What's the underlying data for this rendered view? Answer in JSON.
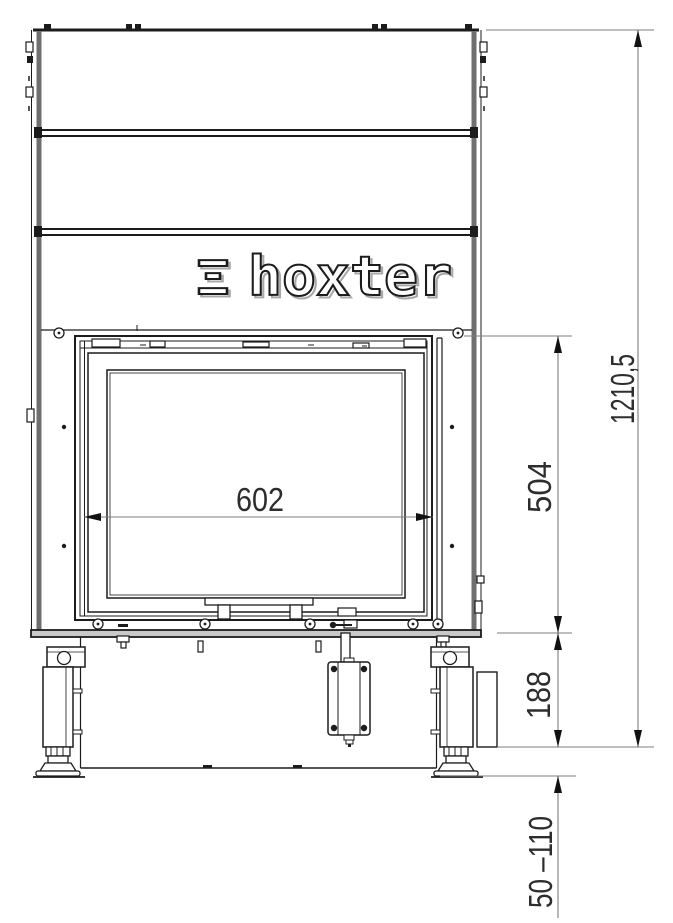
{
  "drawing": {
    "type": "fireplace-insert-front-view-technical-drawing",
    "brand": {
      "glyph": "Ξ",
      "name": "hoxter"
    },
    "dimension_labels": {
      "glass_width": "602",
      "door_section_height": "504",
      "base_section_height": "188",
      "overall_height": "1210,5",
      "adjustable_foot_range": "50 –110"
    },
    "colors": {
      "line": "#1c1c1c",
      "panel_gray": "#6f6f6f",
      "rail_fill": "#c9c9c9",
      "dimension_line": "#7c7c7c",
      "dimension_text": "#2d2d2d",
      "background": "#ffffff"
    }
  }
}
